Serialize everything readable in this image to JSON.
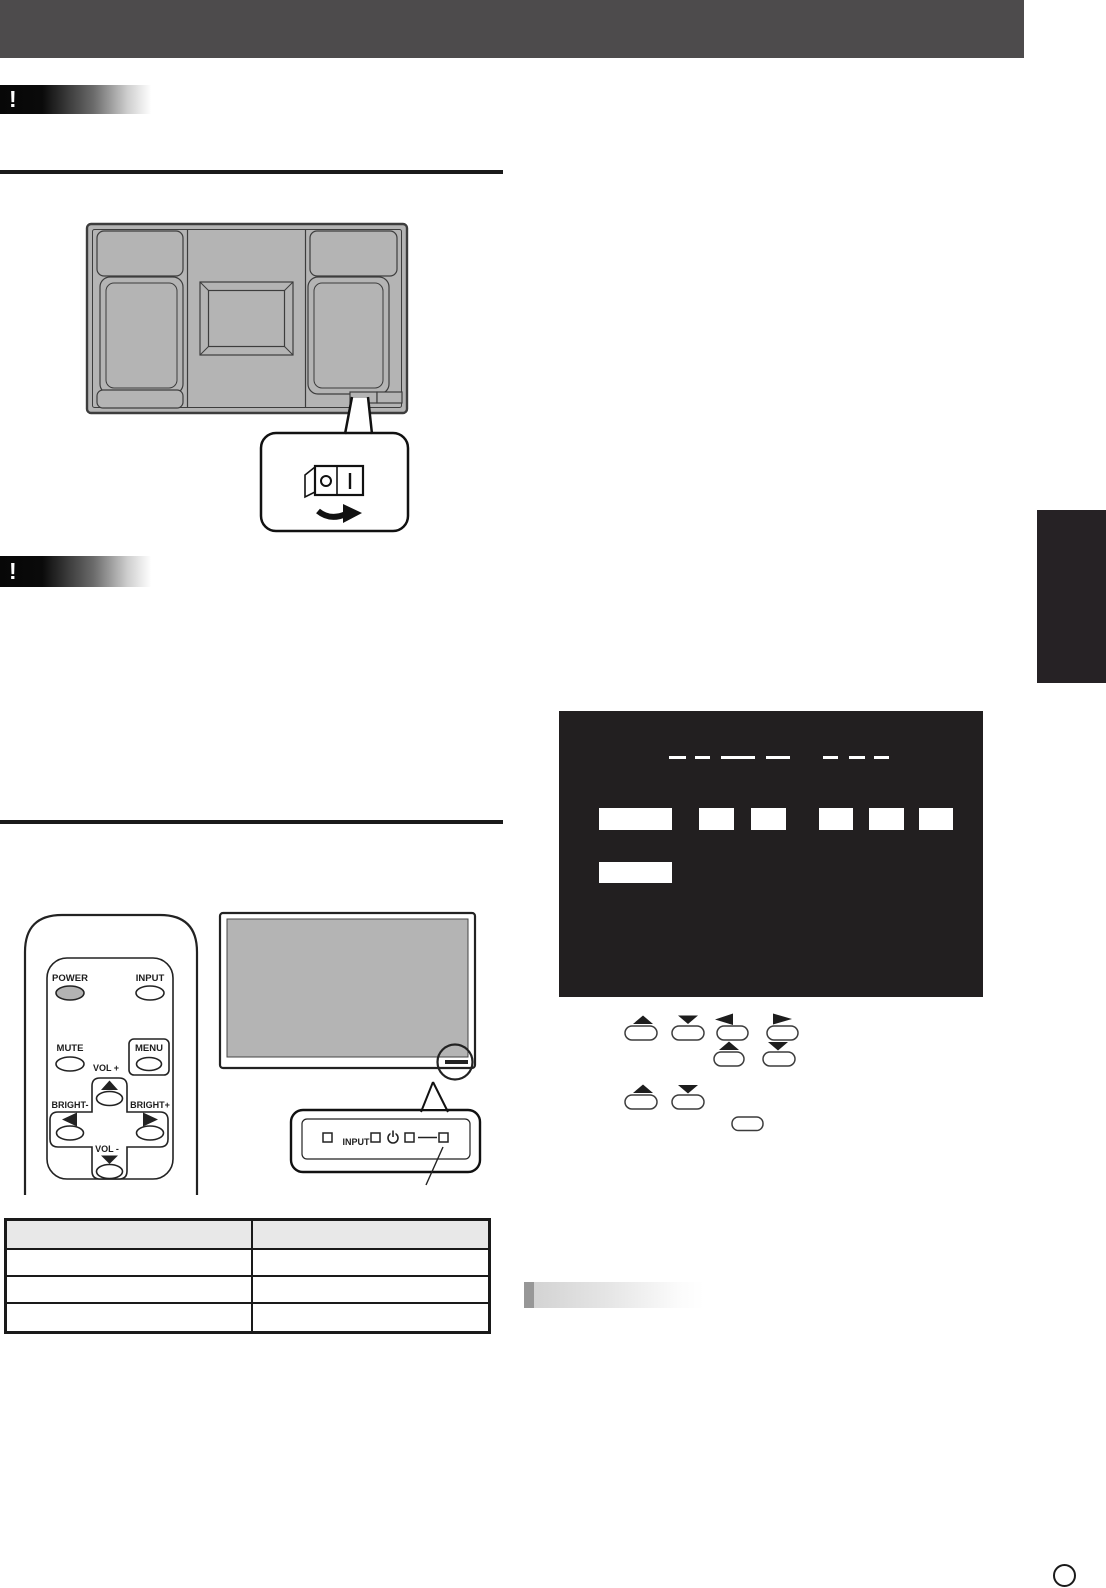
{
  "page": {
    "width": 1106,
    "height": 1588
  },
  "colors": {
    "header_bar": "#4d4b4c",
    "diagram_gray": "#b4b4b4",
    "osd_background": "#221f20",
    "side_tab": "#262225",
    "rule": "#1a1a1a"
  },
  "caution_badge": {
    "icon": "!"
  },
  "remote": {
    "power": "POWER",
    "input": "INPUT",
    "mute": "MUTE",
    "menu": "MENU",
    "vol_plus": "VOL +",
    "vol_minus": "VOL -",
    "bright_minus": "BRIGHT-",
    "bright_plus": "BRIGHT+"
  },
  "indicator_panel": {
    "input": "INPUT"
  }
}
